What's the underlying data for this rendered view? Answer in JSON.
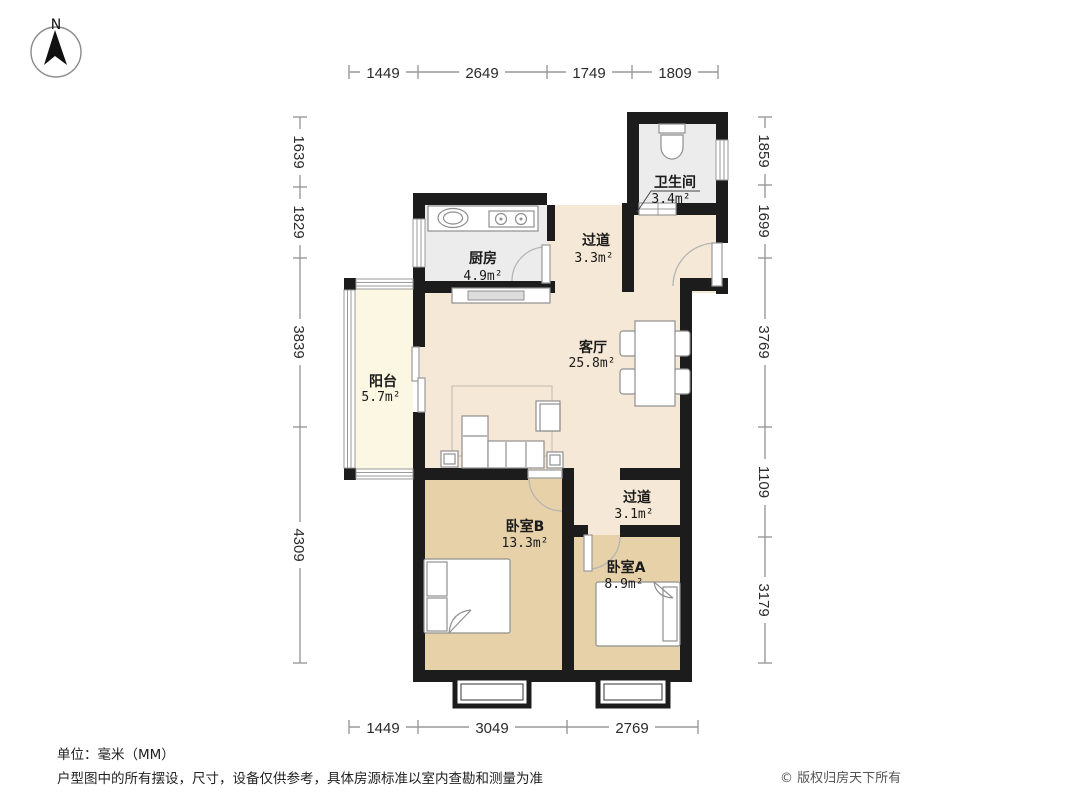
{
  "compass": {
    "label": "N"
  },
  "dims": {
    "top": [
      "1449",
      "2649",
      "1749",
      "1809"
    ],
    "bottom": [
      "1449",
      "3049",
      "2769"
    ],
    "left": [
      "1639",
      "1829",
      "3839",
      "4309"
    ],
    "right": [
      "1859",
      "1699",
      "3769",
      "1109",
      "3179"
    ]
  },
  "rooms": {
    "bathroom": {
      "name": "卫生间",
      "area": "3.4m²"
    },
    "kitchen": {
      "name": "厨房",
      "area": "4.9m²"
    },
    "hall_upper": {
      "name": "过道",
      "area": "3.3m²"
    },
    "living": {
      "name": "客厅",
      "area": "25.8m²"
    },
    "balcony": {
      "name": "阳台",
      "area": "5.7m²"
    },
    "hall_lower": {
      "name": "过道",
      "area": "3.1m²"
    },
    "bedroom_b": {
      "name": "卧室B",
      "area": "13.3m²"
    },
    "bedroom_a": {
      "name": "卧室A",
      "area": "8.9m²"
    }
  },
  "footer": {
    "unit": "单位：毫米（MM）",
    "disclaimer": "户型图中的所有摆设，尺寸，设备仅供参考，具体房源标准以室内查勘和测量为准",
    "copyright": "© 版权归房天下所有"
  },
  "colors": {
    "wall": "#1c1c1c",
    "floor_living": "#f5e8d6",
    "floor_bedroom": "#e7d1a8",
    "floor_wet": "#ececec",
    "floor_balcony": "#fbf7e2"
  }
}
